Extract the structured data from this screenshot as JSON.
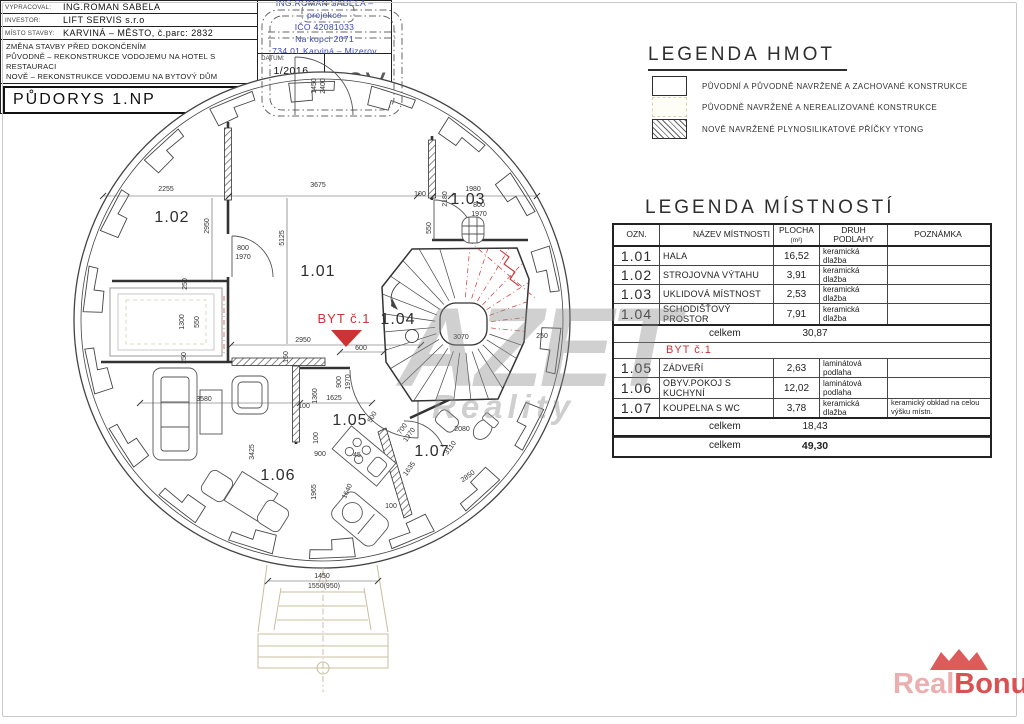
{
  "colors": {
    "accent_red": "#cc3333",
    "firm_blue": "#3a45b8",
    "line": "#3c3c3c",
    "unrealized": "#c8bf9e",
    "watermark_gray": "#8a8a8a",
    "realbonus_red": "#d63e3e"
  },
  "watermark": {
    "azet": "AZET",
    "azet_sub": "Reality",
    "rb_real": "Real",
    "rb_bonus": "Bonus",
    "rb_tld": ".cz"
  },
  "legend_hmot": {
    "title": "LEGENDA HMOT",
    "items": [
      {
        "swatch": "solid-box",
        "label": "PŮVODNÍ A PŮVODNĚ NAVRŽENÉ A ZACHOVANÉ KONSTRUKCE"
      },
      {
        "swatch": "faint-box",
        "label": "PŮVODNĚ NAVRŽENÉ A NEREALIZOVANÉ KONSTRUKCE"
      },
      {
        "swatch": "hatch-box",
        "label": "NOVĚ NAVRŽENÉ PLYNOSILIKATOVÉ PŘÍČKY YTONG"
      }
    ]
  },
  "rooms_table": {
    "title": "LEGENDA MÍSTNOSTÍ",
    "col_ozn": "OZN.",
    "col_name": "NÁZEV MÍSTNOSTI",
    "col_area": "PLOCHA",
    "col_area_sub": "(m²)",
    "col_floor": "DRUH PODLAHY",
    "col_note": "POZNÁMKA",
    "section1": [
      {
        "ozn": "1.01",
        "name": "HALA",
        "area": "16,52",
        "floor": "keramická dlažba",
        "note": ""
      },
      {
        "ozn": "1.02",
        "name": "STROJOVNA VÝTAHU",
        "area": "3,91",
        "floor": "keramická dlažba",
        "note": ""
      },
      {
        "ozn": "1.03",
        "name": "UKLIDOVÁ MÍSTNOST",
        "area": "2,53",
        "floor": "keramická dlažba",
        "note": ""
      },
      {
        "ozn": "1.04",
        "name": "SCHODIŠŤOVÝ PROSTOR",
        "area": "7,91",
        "floor": "keramická dlažba",
        "note": ""
      }
    ],
    "subtotal1_label": "celkem",
    "subtotal1": "30,87",
    "byt_header": "BYT č.1",
    "section2": [
      {
        "ozn": "1.05",
        "name": "ZÁDVEŘÍ",
        "area": "2,63",
        "floor": "laminátová podlaha",
        "note": ""
      },
      {
        "ozn": "1.06",
        "name": "OBYV.POKOJ S KUCHYNÍ",
        "area": "12,02",
        "floor": "laminátová podlaha",
        "note": ""
      },
      {
        "ozn": "1.07",
        "name": "KOUPELNA S WC",
        "area": "3,78",
        "floor": "keramická dlažba",
        "note": "keramický obklad na celou výšku místn."
      }
    ],
    "subtotal2_label": "celkem",
    "subtotal2": "18,43",
    "total_label": "celkem",
    "total": "49,30"
  },
  "title_block": {
    "vypracoval_label": "VYPRACOVAL:",
    "vypracoval": "ING.ROMAN SABELA",
    "investor_label": "INVESTOR:",
    "investor": "LIFT SERVIS s.r.o",
    "misto_label": "MÍSTO STAVBY:",
    "misto": "KARVINÁ – MĚSTO, č.parc: 2832",
    "desc1": "ZMĚNA STAVBY PŘED DOKONČENÍM",
    "desc2": "PŮVODNĚ – REKONSTRUKCE VODOJEMU NA HOTEL S RESTAURACI",
    "desc3": "NOVĚ –  REKONSTRUKCE VODOJEMU NA BYTOVÝ DŮM",
    "drawing_title": "PŮDORYS 1.NP",
    "firm1": "ING.ROMAN SABELA – projekce",
    "firm2": "IČO 42081033",
    "firm3": "Na kopci 2071",
    "firm4": "734 01 Karviná – Mizerov",
    "datum_label": "DATUM:",
    "datum": "1/2016",
    "meritko_label": "MĚŘÍTKO:",
    "meritko": "1:50",
    "number": "03V"
  },
  "plan": {
    "byt_flag": "BYT č.1",
    "room_labels": [
      {
        "t": "1.01",
        "x": 318,
        "y": 276
      },
      {
        "t": "1.02",
        "x": 172,
        "y": 222
      },
      {
        "t": "1.03",
        "x": 468,
        "y": 204
      },
      {
        "t": "1.04",
        "x": 398,
        "y": 324
      },
      {
        "t": "1.05",
        "x": 350,
        "y": 425
      },
      {
        "t": "1.06",
        "x": 278,
        "y": 480
      },
      {
        "t": "1.07",
        "x": 432,
        "y": 456
      }
    ],
    "dims": [
      {
        "t": "2255",
        "x": 166,
        "y": 191
      },
      {
        "t": "3675",
        "x": 318,
        "y": 187
      },
      {
        "t": "100",
        "x": 420,
        "y": 196
      },
      {
        "t": "2180",
        "x": 447,
        "y": 199,
        "r": -90
      },
      {
        "t": "1980",
        "x": 473,
        "y": 191
      },
      {
        "t": "1450",
        "x": 316,
        "y": 86,
        "r": -90
      },
      {
        "t": "2400",
        "x": 325,
        "y": 86,
        "r": -90
      },
      {
        "t": "2950",
        "x": 209,
        "y": 226,
        "r": -90
      },
      {
        "t": "5125",
        "x": 284,
        "y": 238,
        "r": -90
      },
      {
        "t": "800",
        "x": 243,
        "y": 250
      },
      {
        "t": "1970",
        "x": 243,
        "y": 259
      },
      {
        "t": "550",
        "x": 199,
        "y": 322,
        "r": -90
      },
      {
        "t": "800",
        "x": 479,
        "y": 207
      },
      {
        "t": "1970",
        "x": 479,
        "y": 216
      },
      {
        "t": "550",
        "x": 431,
        "y": 228,
        "r": -90
      },
      {
        "t": "2950",
        "x": 303,
        "y": 342
      },
      {
        "t": "150",
        "x": 288,
        "y": 357,
        "r": -90
      },
      {
        "t": "250",
        "x": 187,
        "y": 284,
        "r": -90
      },
      {
        "t": "1300",
        "x": 184,
        "y": 322,
        "r": -90
      },
      {
        "t": "250",
        "x": 186,
        "y": 358,
        "r": -90
      },
      {
        "t": "600",
        "x": 361,
        "y": 350
      },
      {
        "t": "900",
        "x": 341,
        "y": 382,
        "r": -90
      },
      {
        "t": "1970",
        "x": 350,
        "y": 382,
        "r": -90
      },
      {
        "t": "1625",
        "x": 334,
        "y": 400
      },
      {
        "t": "1360",
        "x": 317,
        "y": 396,
        "r": -90
      },
      {
        "t": "100",
        "x": 304,
        "y": 408
      },
      {
        "t": "3580",
        "x": 204,
        "y": 401
      },
      {
        "t": "3425",
        "x": 254,
        "y": 452,
        "r": -90
      },
      {
        "t": "100",
        "x": 318,
        "y": 438,
        "r": -90
      },
      {
        "t": "900",
        "x": 320,
        "y": 456
      },
      {
        "t": "45",
        "x": 357,
        "y": 457
      },
      {
        "t": "1965",
        "x": 316,
        "y": 492,
        "r": -90
      },
      {
        "t": "1640",
        "x": 349,
        "y": 492,
        "r": -65
      },
      {
        "t": "500",
        "x": 374,
        "y": 418,
        "r": -60
      },
      {
        "t": "700",
        "x": 404,
        "y": 430,
        "r": -55
      },
      {
        "t": "1970",
        "x": 411,
        "y": 436,
        "r": -55
      },
      {
        "t": "2080",
        "x": 462,
        "y": 431
      },
      {
        "t": "3110",
        "x": 452,
        "y": 449,
        "r": -55
      },
      {
        "t": "1635",
        "x": 411,
        "y": 470,
        "r": -55
      },
      {
        "t": "2850",
        "x": 469,
        "y": 478,
        "r": -35
      },
      {
        "t": "100",
        "x": 391,
        "y": 508
      },
      {
        "t": "3070",
        "x": 461,
        "y": 339
      },
      {
        "t": "250",
        "x": 542,
        "y": 338
      },
      {
        "t": "1450",
        "x": 322,
        "y": 578
      },
      {
        "t": "1550(950)",
        "x": 324,
        "y": 588
      }
    ]
  }
}
